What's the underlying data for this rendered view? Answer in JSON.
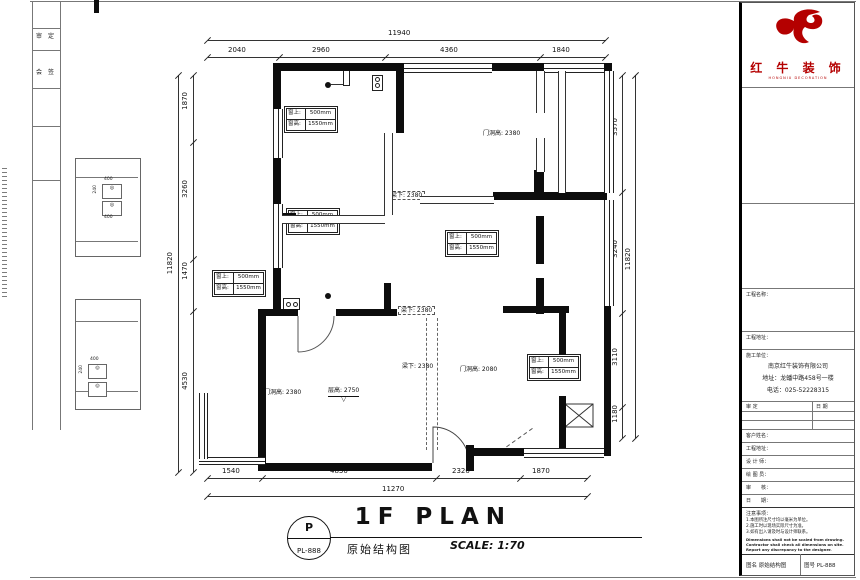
{
  "frame": {
    "strip_cells": [
      "审",
      "定",
      "会",
      "签"
    ]
  },
  "logo": {
    "brand": "红 牛 装 饰",
    "sub": "HONGNIU DECORATION",
    "color": "#b40000"
  },
  "title_block": {
    "section_labels": {
      "project": "工程名称：",
      "address": "工程地址：",
      "company_label": "施工单位："
    },
    "company": {
      "name": "南京红牛装饰有限公司",
      "address": "地址：龙蟠中路458号一楼",
      "phone": "电话：025-52228315"
    },
    "approval": {
      "left": "审 定",
      "right": "日 期"
    },
    "fields": [
      {
        "label": "客户姓名："
      },
      {
        "label": "工程地址："
      },
      {
        "label": "设 计 师："
      },
      {
        "label": "绘 图 员："
      },
      {
        "label": "审　　核："
      },
      {
        "label": "日　　期："
      }
    ],
    "notes": {
      "title": "注意事项：",
      "cn1": "1.本图所注尺寸均以毫米为单位。",
      "cn2": "2.施工时以现场实际尺寸为准。",
      "cn3": "3.如有出入请及时与设计师联系。",
      "en1": "Dimensions shall not be scaled from drawing.",
      "en2": "Contractor shall check all dimensions on site.",
      "en3": "Report any discrepancy to the designer."
    },
    "footer": {
      "left": "图名  原始结构图",
      "right": "图号  PL-888"
    }
  },
  "drawing_title": {
    "badge_top": "P",
    "badge_bottom": "PL-888",
    "name_cn": "原始结构图",
    "name_en": "1F PLAN",
    "scale": "SCALE: 1:70"
  },
  "dimensions": {
    "top": {
      "total": "11940",
      "segments": [
        "2040",
        "2960",
        "4360",
        "1840"
      ]
    },
    "bottom": {
      "total": "11270",
      "segments": [
        "1540",
        "4830",
        "2320",
        "1870"
      ]
    },
    "left": {
      "total": "11820",
      "segments": [
        "1870",
        "3260",
        "1470",
        "4530"
      ]
    },
    "right": {
      "total": "11820",
      "segments": [
        "3570",
        "3240",
        "3110",
        "1180"
      ]
    }
  },
  "plan_labels": {
    "window_table": {
      "r1c1": "窗上:",
      "r1c2": "500mm",
      "r2c1": "窗高:",
      "r2c2": "1550mm"
    },
    "door_height_a": "门洞高: 2380",
    "door_height_b": "门洞高: 2380",
    "door_height_c": "门洞高: 2080",
    "beam_height": "梁下: 2380",
    "floor_height": "层高: 2750",
    "level_mark": "▽",
    "detail": {
      "w": "400",
      "h": "240"
    }
  }
}
